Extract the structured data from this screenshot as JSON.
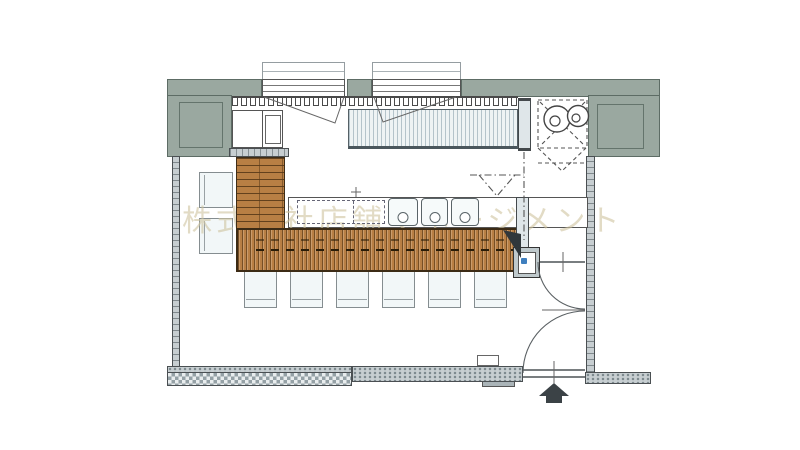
{
  "watermark": {
    "text": "株式会社店舗マネージメント"
  },
  "colors": {
    "wall_accent": "#9aa8a0",
    "wall_gray": "#c7ced1",
    "wood": "#b87f44",
    "wood_dark": "#2a1d08",
    "stripe_blue": "#b4c3ca",
    "seat": "#f2f7f8",
    "accent_blue": "#3f7fbe",
    "watermark_color": "#cfc49f",
    "arrow": "#3b4246"
  },
  "plan": {
    "type": "restaurant-floor-plan",
    "window_count": 2,
    "burner_count": 2,
    "sink_count": 3,
    "counter_stool_count": 6,
    "side_chair_count": 2,
    "door_swing_count": 2,
    "entrance_marker": "arrow-up"
  }
}
